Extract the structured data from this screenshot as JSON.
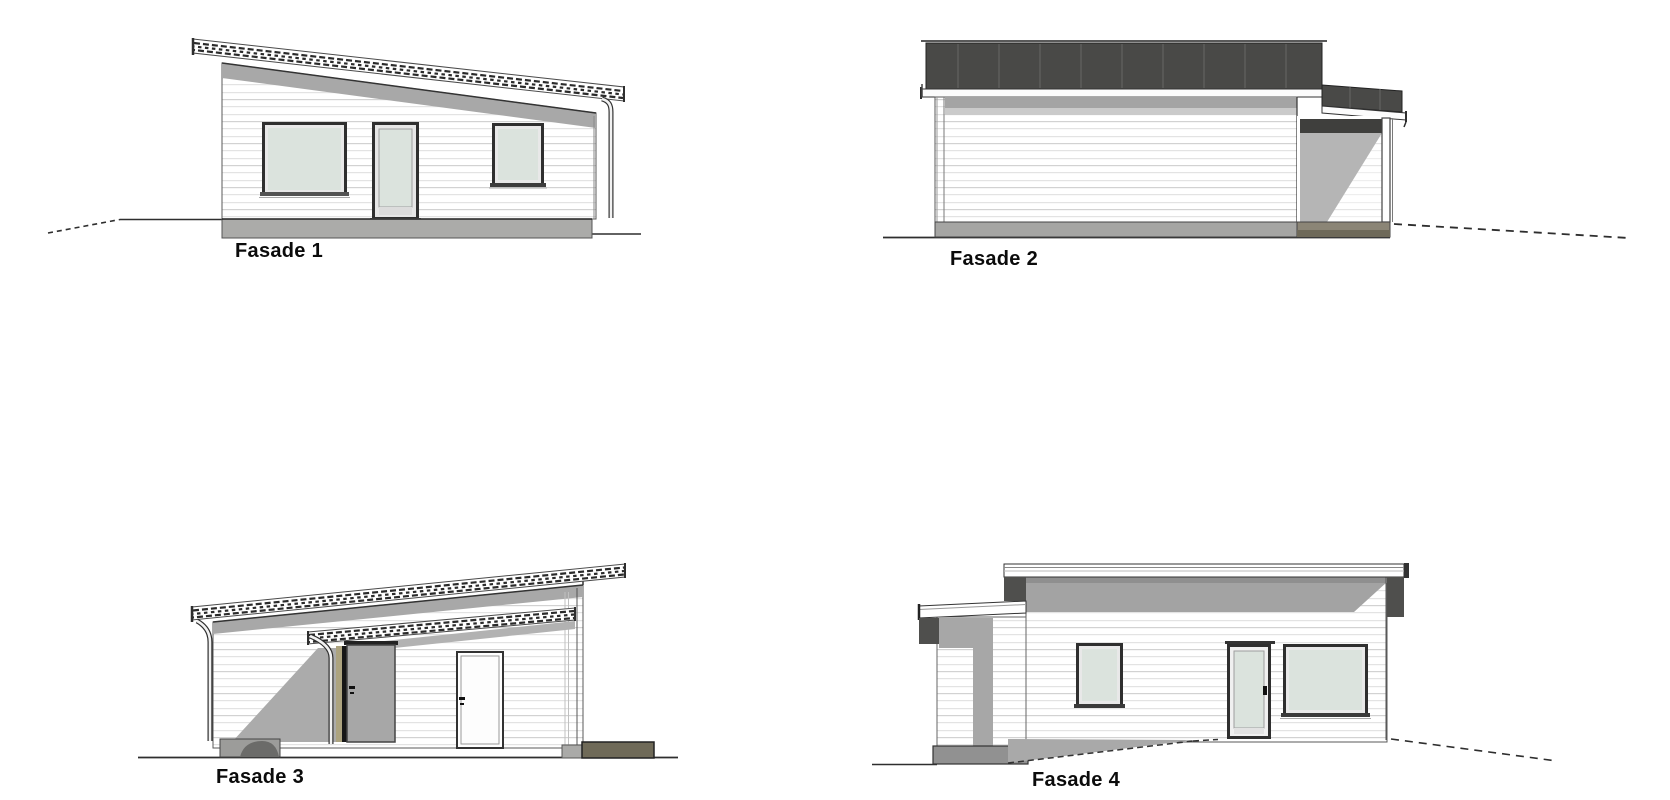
{
  "sheet": {
    "title": "Facade elevation sheet",
    "background": "#ffffff",
    "views": [
      {
        "id": "fasade-1",
        "label": "Fasade 1"
      },
      {
        "id": "fasade-2",
        "label": "Fasade 2"
      },
      {
        "id": "fasade-3",
        "label": "Fasade 3"
      },
      {
        "id": "fasade-4",
        "label": "Fasade 4"
      }
    ],
    "colors": {
      "roof_dark": "#494947",
      "shadow_mid": "#a6a6a6",
      "shadow_light": "#c9c9c9",
      "glass": "#dbe3dd",
      "frame_dark": "#2f2f2f",
      "door_grey": "#a7a7a7",
      "foundation_grey": "#a9a9a7",
      "foundation_olive": "#8b8576",
      "foundation_dark_olive": "#6f6a58",
      "line": "#2e2e2e"
    }
  }
}
